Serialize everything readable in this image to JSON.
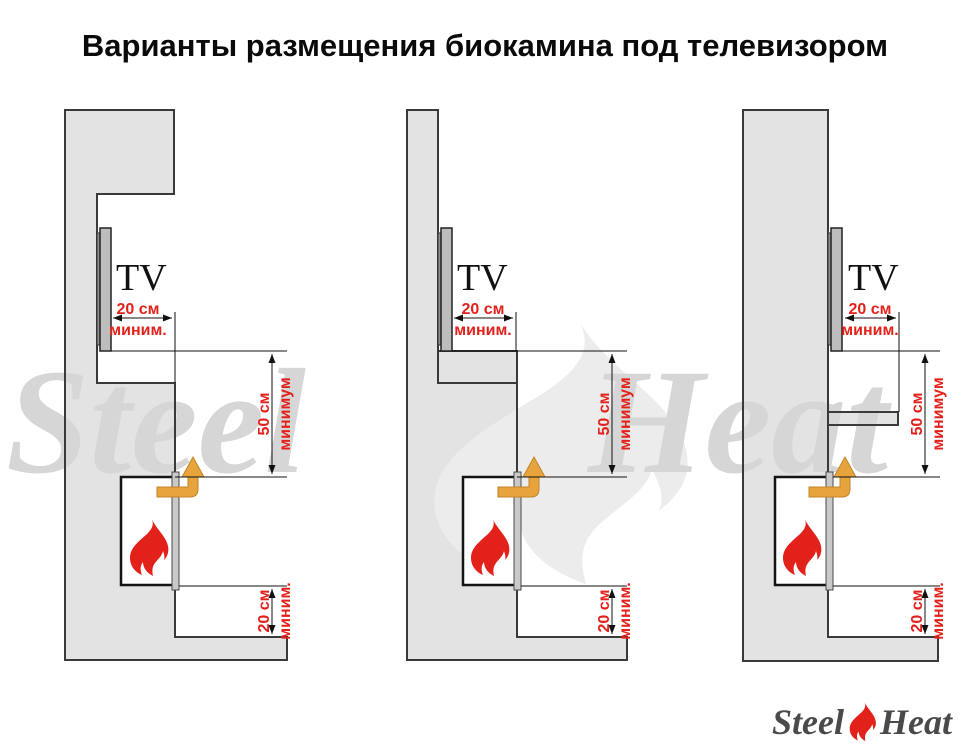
{
  "title": "Варианты размещения биокамина под телевизором",
  "watermark": {
    "word1": "Steel",
    "word2": "Heat"
  },
  "logo": {
    "word1": "Steel",
    "word2": "Heat"
  },
  "diagrams": [
    {
      "tv_label": "TV",
      "dim_tv_clearance": {
        "value": "20 см",
        "qualifier": "миним."
      },
      "dim_fireplace_to_tv": {
        "value": "50 см",
        "qualifier": "минимум"
      },
      "dim_fireplace_to_base": {
        "value": "20 см",
        "qualifier": "миним."
      }
    },
    {
      "tv_label": "TV",
      "dim_tv_clearance": {
        "value": "20 см",
        "qualifier": "миним."
      },
      "dim_fireplace_to_tv": {
        "value": "50 см",
        "qualifier": "минимум"
      },
      "dim_fireplace_to_base": {
        "value": "20 см",
        "qualifier": "миним."
      }
    },
    {
      "tv_label": "TV",
      "dim_tv_clearance": {
        "value": "20 см",
        "qualifier": "миним."
      },
      "dim_fireplace_to_tv": {
        "value": "50 см",
        "qualifier": "минимум"
      },
      "dim_fireplace_to_base": {
        "value": "20 см",
        "qualifier": "миним."
      }
    }
  ],
  "colors": {
    "wall_fill": "#e3e3e3",
    "outline": "#3a3a3a",
    "dimension_red": "#e3211b",
    "flame_red": "#e3211b",
    "arrow_amber": "#e7a43c",
    "watermark_text_gray": "#d6d6d6",
    "watermark_flame_gray": "#ececec",
    "logo_text_gray": "#4a4a4a"
  }
}
